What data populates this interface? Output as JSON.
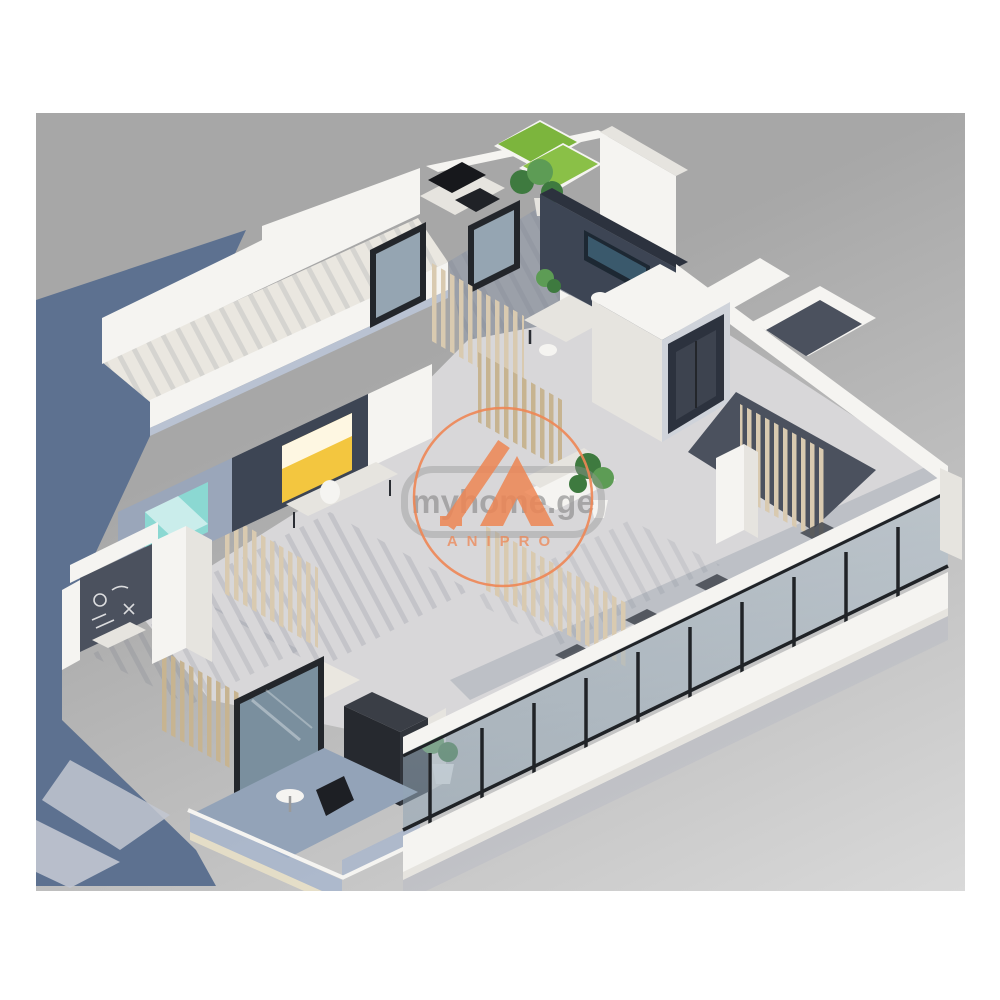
{
  "scene": {
    "description": "Isometric 3D cutaway render of an apartment floor plan with open office, wooden slat partitions, glass curtain facade and balcony",
    "style": "architectural-3d-render"
  },
  "watermark": {
    "site": "myhome.ge",
    "brand": "ANIPRO"
  },
  "palette": {
    "bg_page": "#ffffff",
    "bg_top": "#a7a7a7",
    "bg_bottom": "#d9d9d9",
    "shadow_blue": "#5d7190",
    "shadow_soft": "#c2c7d1",
    "wall": "#f5f4f1",
    "wall_side": "#e6e4df",
    "wall_shade": "#b9c2d2",
    "wall_cool": "#9aa6ba",
    "floor": "#d8d7d9",
    "floor_warm": "#eae7e0",
    "floor_dark": "#9ba0a9",
    "floor_slate": "#4b515e",
    "navy": "#3d4554",
    "navy_deep": "#2c323e",
    "wood": "#d9cab0",
    "wood_dark": "#c7b491",
    "grass": "#7cb53d",
    "grass2": "#8ac047",
    "leaf": "#3e7a3f",
    "leaf2": "#5d9c55",
    "glass": "#a9bcca",
    "frame": "#23262b",
    "yellow": "#f3c63f",
    "teal": "#8bd8d2",
    "orange": "#ee8654",
    "wm_gray": "#8f8f8f"
  }
}
